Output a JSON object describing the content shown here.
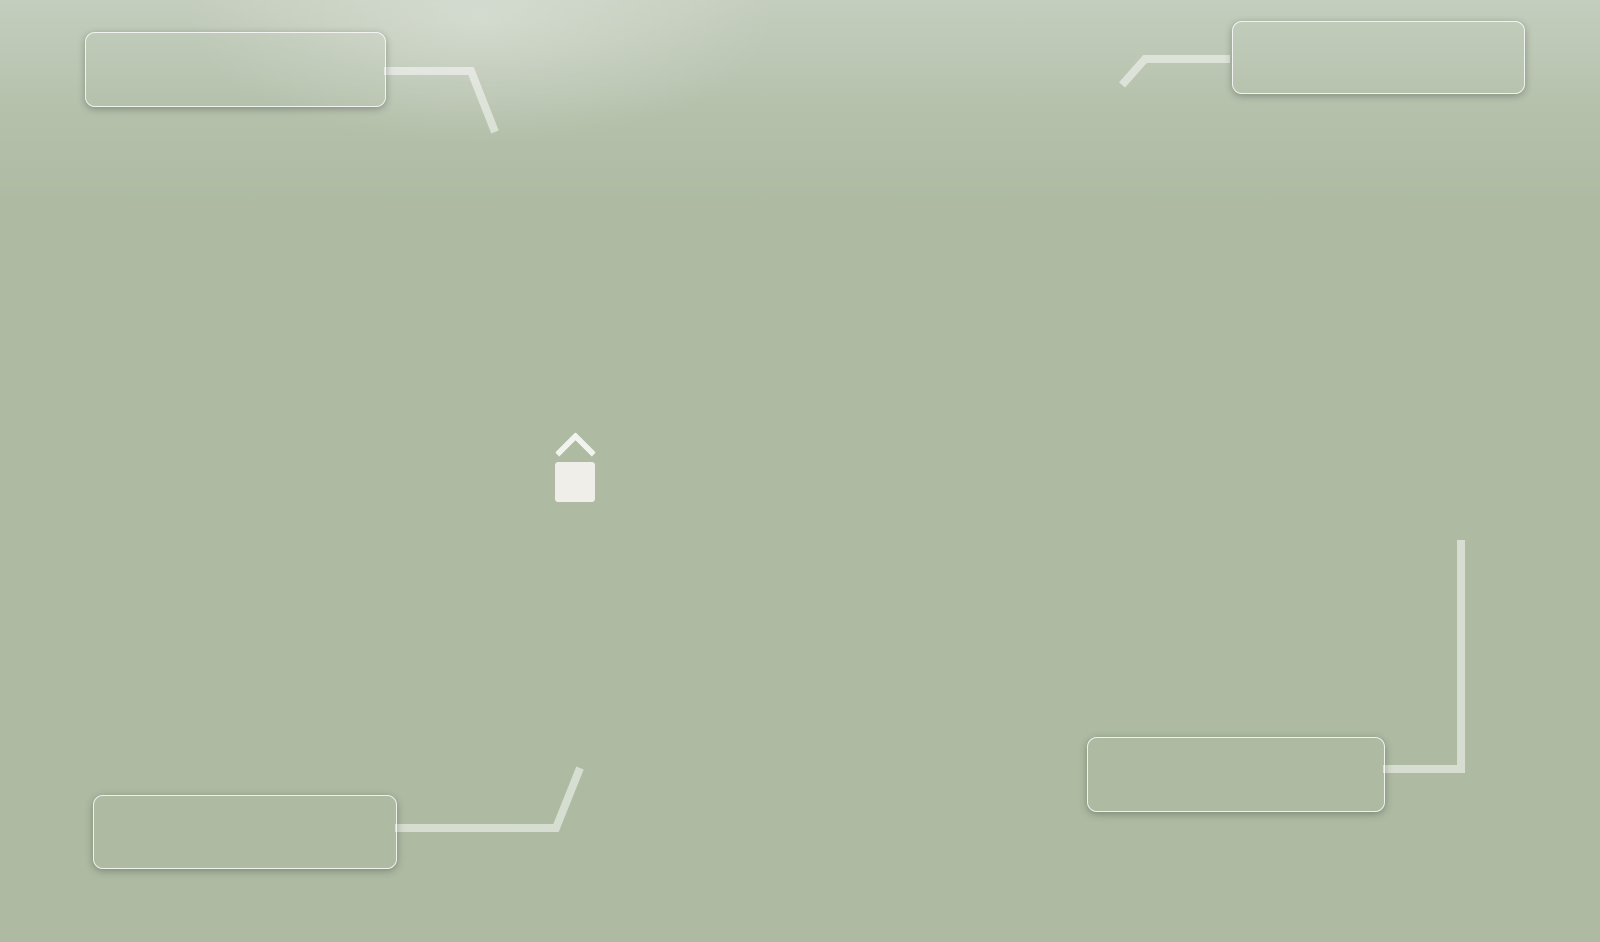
{
  "callouts": [
    {
      "id": "q3-2025",
      "position": "top-left",
      "line1": "Будинки, що здаються",
      "line2": "у  3 кварталі 2025 року"
    },
    {
      "id": "q4-2025",
      "position": "top-right",
      "line1": "Будинки, що здаються",
      "line2": "у  4 кварталі 2025 року"
    },
    {
      "id": "q4-2024",
      "position": "bottom-left",
      "line1": "Будинки, що здаються",
      "line2": "у 4 кварталі 2024 року"
    },
    {
      "id": "q1-2026",
      "position": "bottom-right",
      "line1": "Будинки, що здаються",
      "line2": "у 1 кварталі 2026 року"
    }
  ],
  "watermark": {
    "logo_letter": "A",
    "text": "AVANGARD"
  },
  "colors": {
    "arrow_red": "#e8291c",
    "callout_bg": "rgba(48,48,48,0.78)",
    "callout_border": "rgba(252,252,252,0.85)",
    "callout_text": "#f3f4f2",
    "building_white": "#f2f4f6",
    "building_white_shade": "#e2e6eb",
    "building_red": "#b14a40",
    "building_red_shade": "#8e352d",
    "building_yellow": "#eccf9b",
    "building_yellow_shade": "#dcba7f",
    "roof_gray": "#ced2d8",
    "window_dark": "#4a5260",
    "road_asphalt": "#7e8186",
    "sidewalk": "#d3d5d8",
    "forest_dark": "#4e6246",
    "forest_mid": "#7b9268",
    "forest_light": "#a9ba9c",
    "playground_pink": "#dfa29b",
    "playground_mint": "#c9dcc6",
    "watermark_logo_red": "#c23b31",
    "watermark_text": "rgba(95,105,120,0.52)"
  }
}
